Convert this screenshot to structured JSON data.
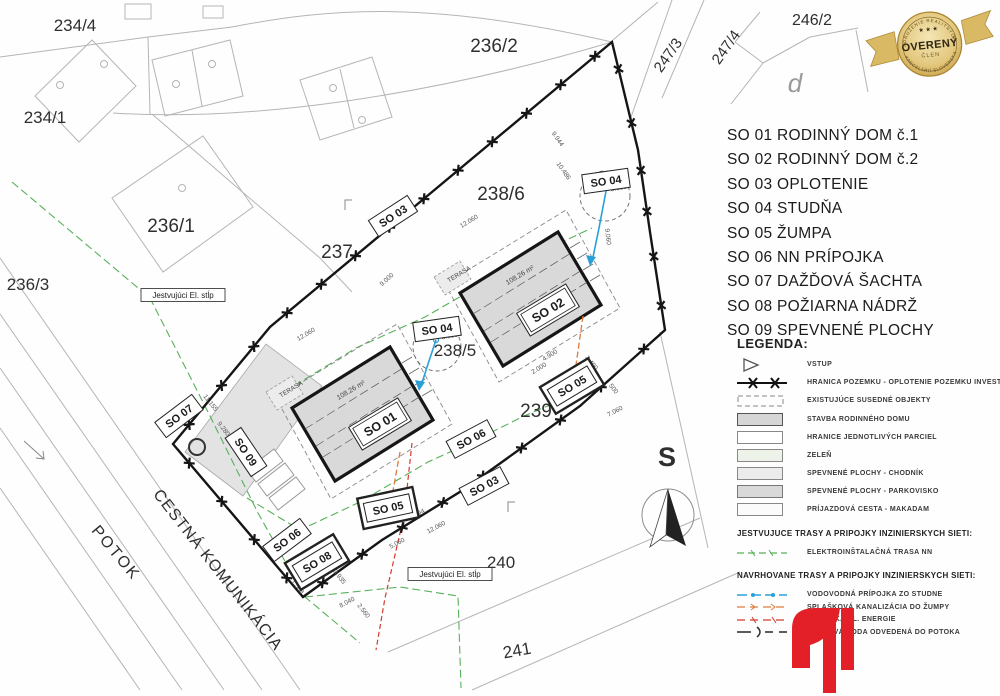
{
  "objects_list": [
    {
      "code": "SO 01",
      "name": "RODINNÝ DOM č.1"
    },
    {
      "code": "SO 02",
      "name": "RODINNÝ DOM č.2"
    },
    {
      "code": "SO 03",
      "name": "OPLOTENIE"
    },
    {
      "code": "SO 04",
      "name": "STUDŇA"
    },
    {
      "code": "SO 05",
      "name": "ŽUMPA"
    },
    {
      "code": "SO 06",
      "name": "NN PRÍPOJKA"
    },
    {
      "code": "SO 07",
      "name": "DAŽĎOVÁ ŠACHTA"
    },
    {
      "code": "SO 08",
      "name": "POŽIARNA NÁDRŽ"
    },
    {
      "code": "SO 09",
      "name": "SPEVNENÉ PLOCHY"
    }
  ],
  "legend": {
    "title": "LEGENDA:",
    "items": [
      {
        "symbol": "entry",
        "label": "VSTUP"
      },
      {
        "symbol": "fence",
        "label": "HRANICA POZEMKU - OPLOTENIE POZEMKU INVESTORA"
      },
      {
        "symbol": "dashedrect",
        "label": "EXISTUJÚCE SUSEDNÉ OBJEKTY"
      },
      {
        "symbol": "grayrect",
        "label": "STAVBA RODINNÉHO DOMU"
      },
      {
        "symbol": "whiterect",
        "label": "HRANICE JEDNOTLIVÝCH PARCIEL"
      },
      {
        "symbol": "greenrect",
        "label": "ZELEŇ"
      },
      {
        "symbol": "lightrect",
        "label": "SPEVNENÉ PLOCHY - CHODNÍK"
      },
      {
        "symbol": "midrect",
        "label": "SPEVNENÉ PLOCHY - PARKOVISKO"
      },
      {
        "symbol": "makadam",
        "label": "PRÍJAZDOVÁ CESTA - MAKADAM"
      }
    ],
    "existing_title": "JESTVUJUCE TRASY A PRIPOJKY INZINIERSKYCH SIETI:",
    "existing_items": [
      {
        "symbol": "nnline",
        "label": "ELEKTROINŠTALAČNÁ TRASA NN"
      }
    ],
    "proposed_title": "NAVRHOVANE TRASY A PRIPOJKY INZINIERSKYCH SIETI:",
    "proposed_items": [
      {
        "symbol": "water",
        "label": "VODOVODNÁ PRÍPOJKA ZO STUDNE"
      },
      {
        "symbol": "sewer",
        "label": "SPLAŠKOVÁ KANALIZÁCIA DO ŽUMPY"
      },
      {
        "symbol": "power",
        "label": "PRÍPOJKA EL. ENERGIE"
      },
      {
        "symbol": "rain",
        "label": "DAŽĎOVÁ VODA ODVEDENÁ DO POTOKA"
      }
    ]
  },
  "badge": {
    "arc_top": "ZDRUŽENIE REALITNÝCH",
    "title": "OVERENÝ",
    "subtitle": "ČLEN",
    "arc_bottom": "KANCELÁRIÍ SLOVENSKA",
    "stars": "★ ★ ★"
  },
  "plan": {
    "labels": [
      {
        "t": "234/4",
        "x": 75,
        "y": 31,
        "s": 17
      },
      {
        "t": "234/1",
        "x": 45,
        "y": 123,
        "s": 17
      },
      {
        "t": "236/2",
        "x": 494,
        "y": 52,
        "s": 19
      },
      {
        "t": "236/1",
        "x": 171,
        "y": 232,
        "s": 19
      },
      {
        "t": "236/3",
        "x": 28,
        "y": 290,
        "s": 17
      },
      {
        "t": "237",
        "x": 337,
        "y": 258,
        "s": 19
      },
      {
        "t": "238/6",
        "x": 501,
        "y": 200,
        "s": 19
      },
      {
        "t": "238/5",
        "x": 455,
        "y": 356,
        "s": 17
      },
      {
        "t": "239",
        "x": 536,
        "y": 417,
        "s": 19
      },
      {
        "t": "240",
        "x": 501,
        "y": 568,
        "s": 17
      },
      {
        "t": "241",
        "x": 518,
        "y": 656,
        "s": 17,
        "r": -10
      },
      {
        "t": "246/2",
        "x": 812,
        "y": 25,
        "s": 16
      },
      {
        "t": "247/3",
        "x": 672,
        "y": 58,
        "s": 15,
        "r": -55
      },
      {
        "t": "247/4",
        "x": 730,
        "y": 50,
        "s": 15,
        "r": -55
      },
      {
        "t": "POTOK",
        "x": 112,
        "y": 556,
        "s": 16,
        "r": 50,
        "ls": 2
      },
      {
        "t": "CESTNÁ KOMUNIKÁCIA",
        "x": 214,
        "y": 573,
        "s": 16,
        "r": 52,
        "ls": 1
      },
      {
        "t": "d",
        "x": 795,
        "y": 92,
        "s": 26,
        "c": "#9a9a9a",
        "i": true
      },
      {
        "t": "S",
        "x": 667,
        "y": 466,
        "s": 27,
        "w": "600"
      }
    ],
    "areas": [
      {
        "t": "108.26 m²",
        "x": 352,
        "y": 392,
        "r": -31,
        "s": 7
      },
      {
        "t": "108.26 m²",
        "x": 521,
        "y": 277,
        "r": -31,
        "s": 7
      },
      {
        "t": "TERASA",
        "x": 292,
        "y": 391,
        "r": -31,
        "s": 6.5
      },
      {
        "t": "TERASA",
        "x": 460,
        "y": 276,
        "r": -31,
        "s": 6.5
      }
    ],
    "dims": [
      {
        "t": "12.060",
        "x": 307,
        "y": 336,
        "r": -31
      },
      {
        "t": "12.060",
        "x": 470,
        "y": 223,
        "r": -31
      },
      {
        "t": "12.060",
        "x": 437,
        "y": 529,
        "r": -28
      },
      {
        "t": "9.000",
        "x": 388,
        "y": 281,
        "r": -42
      },
      {
        "t": "9.944",
        "x": 556,
        "y": 140,
        "r": 55
      },
      {
        "t": "10.486",
        "x": 562,
        "y": 172,
        "r": 55
      },
      {
        "t": "9.060",
        "x": 606,
        "y": 237,
        "r": 83
      },
      {
        "t": "3.000",
        "x": 619,
        "y": 190,
        "r": -10
      },
      {
        "t": "3.000",
        "x": 450,
        "y": 338,
        "r": -10
      },
      {
        "t": "9.280",
        "x": 222,
        "y": 430,
        "r": 52
      },
      {
        "t": "11.155",
        "x": 209,
        "y": 404,
        "r": 52
      },
      {
        "t": "3.935",
        "x": 338,
        "y": 578,
        "r": 52
      },
      {
        "t": "2.560",
        "x": 362,
        "y": 612,
        "r": 52
      },
      {
        "t": "1.500",
        "x": 296,
        "y": 588,
        "r": 52
      },
      {
        "t": "5.060",
        "x": 398,
        "y": 545,
        "r": -28
      },
      {
        "t": "8.040",
        "x": 348,
        "y": 604,
        "r": -28
      },
      {
        "t": "5.094",
        "x": 418,
        "y": 516,
        "r": -28
      },
      {
        "t": "2.000",
        "x": 540,
        "y": 370,
        "r": -31
      },
      {
        "t": "4.900",
        "x": 551,
        "y": 357,
        "r": -31
      },
      {
        "t": "2.400",
        "x": 590,
        "y": 364,
        "r": 52
      },
      {
        "t": "500",
        "x": 612,
        "y": 390,
        "r": 52
      },
      {
        "t": "7.060",
        "x": 616,
        "y": 413,
        "r": -28
      }
    ],
    "boxes": [
      {
        "t": "SO 03",
        "x": 393,
        "y": 216,
        "r": -33,
        "st": "plain"
      },
      {
        "t": "SO 03",
        "x": 484,
        "y": 486,
        "r": -28,
        "st": "plain"
      },
      {
        "t": "SO 04",
        "x": 606,
        "y": 181,
        "r": -8,
        "st": "plain"
      },
      {
        "t": "SO 04",
        "x": 437,
        "y": 329,
        "r": -8,
        "st": "plain"
      },
      {
        "t": "SO 01",
        "x": 380,
        "y": 424,
        "r": -31,
        "st": "double"
      },
      {
        "t": "SO 02",
        "x": 548,
        "y": 310,
        "r": -31,
        "st": "double"
      },
      {
        "t": "SO 05",
        "x": 572,
        "y": 386,
        "r": -31,
        "st": "object"
      },
      {
        "t": "SO 05",
        "x": 388,
        "y": 508,
        "r": -12,
        "st": "object"
      },
      {
        "t": "SO 08",
        "x": 317,
        "y": 562,
        "r": -31,
        "st": "object"
      },
      {
        "t": "SO 06",
        "x": 287,
        "y": 540,
        "r": -37,
        "st": "plain"
      },
      {
        "t": "SO 06",
        "x": 471,
        "y": 439,
        "r": -28,
        "st": "plain"
      },
      {
        "t": "SO 07",
        "x": 179,
        "y": 416,
        "r": -37,
        "st": "plain"
      },
      {
        "t": "SO 09",
        "x": 246,
        "y": 452,
        "r": 56,
        "st": "plain"
      },
      {
        "t": "Jestvujúci El. stĺp",
        "x": 183,
        "y": 295,
        "r": 0,
        "st": "note"
      },
      {
        "t": "Jestvujúci El. stĺp",
        "x": 450,
        "y": 574,
        "r": 0,
        "st": "note"
      }
    ]
  },
  "colors": {
    "boundary": "#151515",
    "building_fill": "#d9d9d9",
    "water": "#2aa0d8",
    "sewer": "#e07b39",
    "power": "#d23b2f",
    "nn_existing": "#58b05a",
    "logo_red": "#e32028",
    "badge_gold": "#d9b964"
  }
}
